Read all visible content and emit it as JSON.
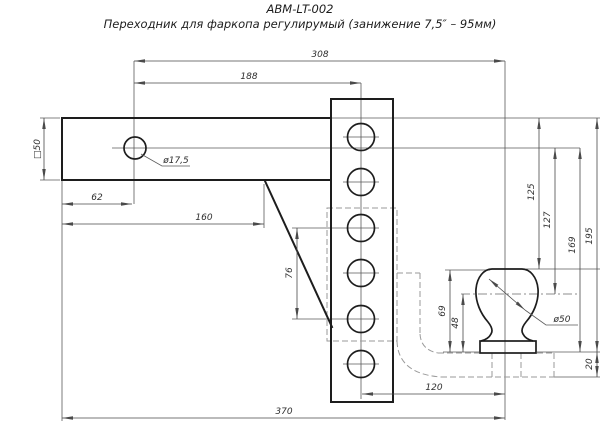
{
  "title": {
    "model": "ABM-LT-002",
    "description": "Переходник для фаркопа регулирумый (занижение 7,5″ – 95мм)"
  },
  "dims": {
    "pin_to_ball": "308",
    "pin_to_post": "188",
    "end_to_pin": "62",
    "end_to_gusset": "160",
    "overall": "370",
    "post_to_ball": "120",
    "hole_span": "76",
    "ball_top_from_platform": "69",
    "ball_center_from_platform": "48",
    "drop_ball_top": "125",
    "drop_ball_center": "127",
    "drop_platform": "169",
    "drop_platform_total": "195",
    "bracket_thickness": "20",
    "tube_section": "□50",
    "pin_hole_dia": "ø17,5",
    "ball_dia": "ø50"
  }
}
